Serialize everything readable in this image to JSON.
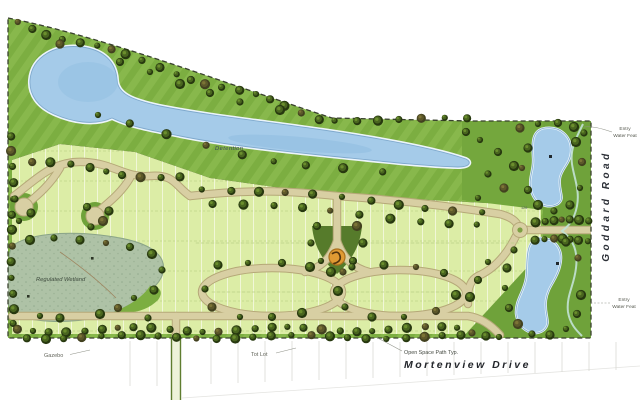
{
  "map": {
    "labels": {
      "detention": "Detention",
      "regulated_wetland": "Regulated Wetland",
      "gazebo": "Gazebo",
      "tot_lot": "Tot Lot",
      "open_space_path": "Open Space Path Typ.",
      "mortenview_drive": "Mortenview Drive",
      "goddard_road": "Goddard Road",
      "entry_water_feature_top": {
        "line1": "Entry",
        "line2": "Water Feat"
      },
      "entry_water_feature_bottom": {
        "line1": "Entry",
        "line2": "Water Feat"
      },
      "lot_126": "126"
    },
    "colors": {
      "water": "#a5cbe9",
      "water_edge": "#7fa9cd",
      "grass": "#7cae41",
      "open_space_green": "#6fa23a",
      "lots": "#dceda6",
      "street": "#d8cfa3",
      "tree_green": "#27380f",
      "wetland": "#aec2a6",
      "feature_orange": "#e09a33",
      "boundary": "#39412e"
    }
  }
}
